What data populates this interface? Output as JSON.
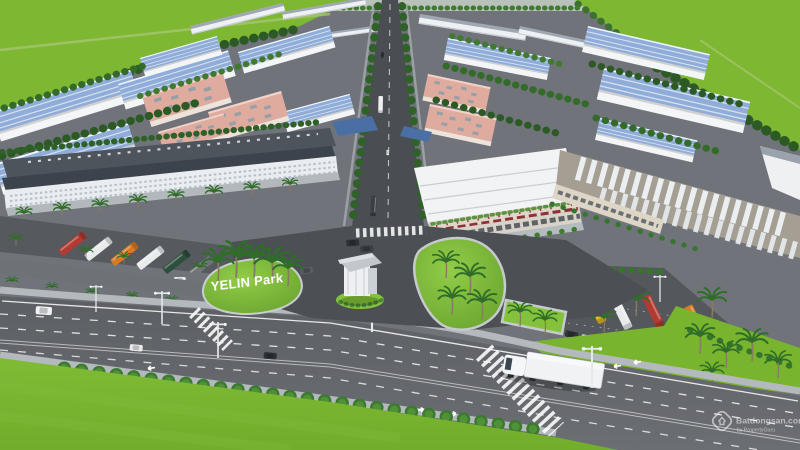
{
  "scene": {
    "kind": "aerial-3d-render-industrial-park"
  },
  "sign": {
    "text": "YELIN Park"
  },
  "watermark": {
    "brand": "Batdongsan.com",
    "byline": "by PropertyGuru"
  },
  "palette": {
    "grass": "#7eb832",
    "lawn": "#79b42e",
    "island_green": "#84c23b",
    "asphalt": "#5d6065",
    "asphalt_dark": "#4a4e53",
    "roof_blue": "#8fadd8",
    "roof_pink": "#dfab9f",
    "roof_dark": "#3c434c",
    "awning_red": "#8e2f3c",
    "palm_green": "#2f6d28",
    "bus_red": "#b23a30",
    "bus_orange": "#d87a22",
    "bus_yellow": "#e5b51f"
  }
}
